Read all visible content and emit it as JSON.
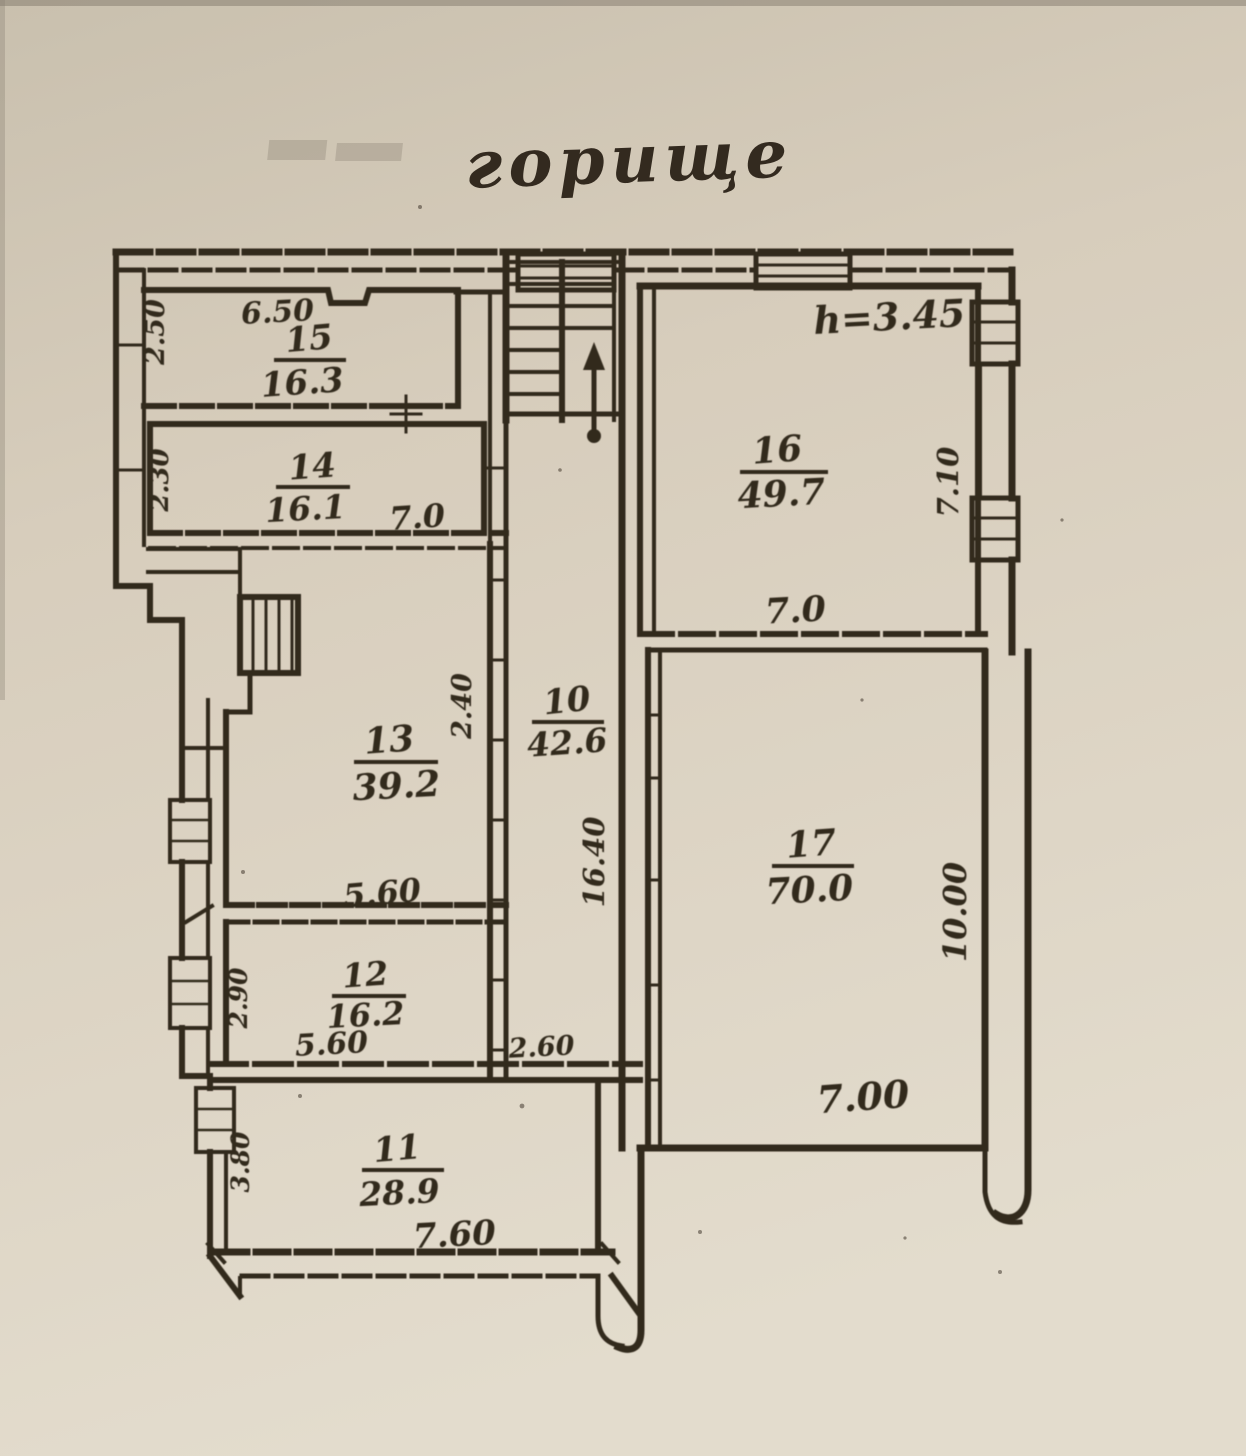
{
  "page": {
    "title": "горище"
  },
  "plan": {
    "height_note": "h=3.45",
    "rooms": {
      "r10": {
        "number": "10",
        "area": "42.6"
      },
      "r11": {
        "number": "11",
        "area": "28.9"
      },
      "r12": {
        "number": "12",
        "area": "16.2"
      },
      "r13": {
        "number": "13",
        "area": "39.2"
      },
      "r14": {
        "number": "14",
        "area": "16.1"
      },
      "r15": {
        "number": "15",
        "area": "16.3"
      },
      "r16": {
        "number": "16",
        "area": "49.7"
      },
      "r17": {
        "number": "17",
        "area": "70.0"
      }
    },
    "dims": {
      "r15_width": "6.50",
      "r15_depth": "2.50",
      "r14_width": "7.0",
      "r14_depth": "2.30",
      "r13_width": "5.60",
      "r13_passage": "2.40",
      "r12_width": "5.60",
      "r12_depth": "2.90",
      "r11_width": "7.60",
      "r11_depth": "3.80",
      "r10_width": "2.60",
      "r10_length": "16.40",
      "r16_width": "7.0",
      "r16_depth": "7.10",
      "r17_width": "7.00",
      "r17_depth": "10.00"
    },
    "colors": {
      "paper": "#d7cdbc",
      "ink": "#332a1f"
    }
  }
}
